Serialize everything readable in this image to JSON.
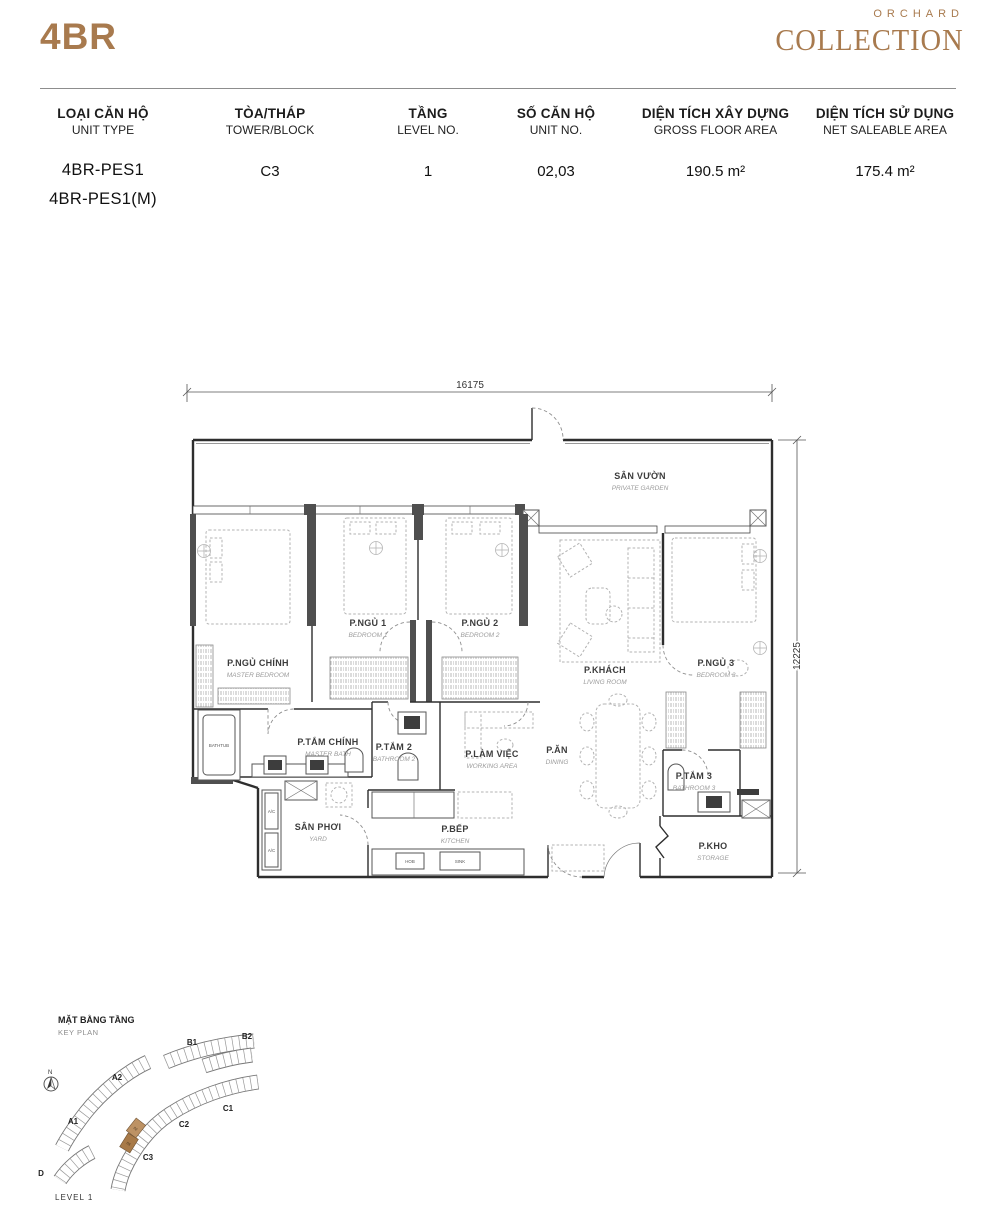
{
  "header": {
    "unit_label": "4BR",
    "brand_top": "ORCHARD",
    "brand_bottom": "COLLECTION"
  },
  "spec_table": {
    "columns": [
      {
        "vi": "LOẠI CĂN HỘ",
        "en": "UNIT TYPE"
      },
      {
        "vi": "TÒA/THÁP",
        "en": "TOWER/BLOCK"
      },
      {
        "vi": "TẦNG",
        "en": "LEVEL NO."
      },
      {
        "vi": "SỐ CĂN HỘ",
        "en": "UNIT NO."
      },
      {
        "vi": "DIỆN TÍCH XÂY DỰNG",
        "en": "GROSS FLOOR AREA"
      },
      {
        "vi": "DIỆN TÍCH SỬ DỤNG",
        "en": "NET SALEABLE AREA"
      }
    ],
    "row": {
      "unit_type_1": "4BR-PES1",
      "unit_type_2": "4BR-PES1(M)",
      "tower": "C3",
      "level": "1",
      "unit_no": "02,03",
      "gross_floor_area": "190.5 m²",
      "net_saleable_area": "175.4 m²"
    }
  },
  "floor_plan": {
    "dim_width": "16175",
    "dim_height": "12225",
    "rooms": {
      "garden": {
        "vi": "SÂN VƯỜN",
        "en": "PRIVATE GARDEN"
      },
      "master_bedroom": {
        "vi": "P.NGỦ CHÍNH",
        "en": "MASTER BEDROOM"
      },
      "bedroom1": {
        "vi": "P.NGỦ 1",
        "en": "BEDROOM 1"
      },
      "bedroom2": {
        "vi": "P.NGỦ 2",
        "en": "BEDROOM 2"
      },
      "living": {
        "vi": "P.KHÁCH",
        "en": "LIVING ROOM"
      },
      "bedroom3": {
        "vi": "P.NGỦ 3",
        "en": "BEDROOM 3"
      },
      "master_bath": {
        "vi": "P.TẮM CHÍNH",
        "en": "MASTER BATH"
      },
      "bath2": {
        "vi": "P.TẮM 2",
        "en": "BATHROOM 2"
      },
      "working": {
        "vi": "P.LÀM VIỆC",
        "en": "WORKING AREA"
      },
      "dining": {
        "vi": "P.ĂN",
        "en": "DINING"
      },
      "bath3": {
        "vi": "P.TẮM 3",
        "en": "BATHROOM 3"
      },
      "yard": {
        "vi": "SÂN PHƠI",
        "en": "YARD"
      },
      "kitchen": {
        "vi": "P.BẾP",
        "en": "KITCHEN"
      },
      "storage": {
        "vi": "P.KHO",
        "en": "STORAGE"
      }
    },
    "fixtures": {
      "bathtub": "BATHTUB",
      "ac": "A/C",
      "hob": "HOB",
      "sink": "SINK"
    }
  },
  "key_plan": {
    "title_vi": "MẶT BẰNG TẦNG",
    "title_en": "KEY PLAN",
    "north": "N",
    "level_label": "LEVEL 1",
    "blocks": {
      "a1": "A1",
      "a2": "A2",
      "b1": "B1",
      "b2": "B2",
      "c1": "C1",
      "c2": "C2",
      "c3": "C3",
      "d": "D"
    },
    "highlighted_units": [
      "02",
      "03"
    ]
  },
  "colors": {
    "accent": "#a87a4e",
    "highlight_dark": "#a87a48",
    "highlight_light": "#bd9264"
  }
}
